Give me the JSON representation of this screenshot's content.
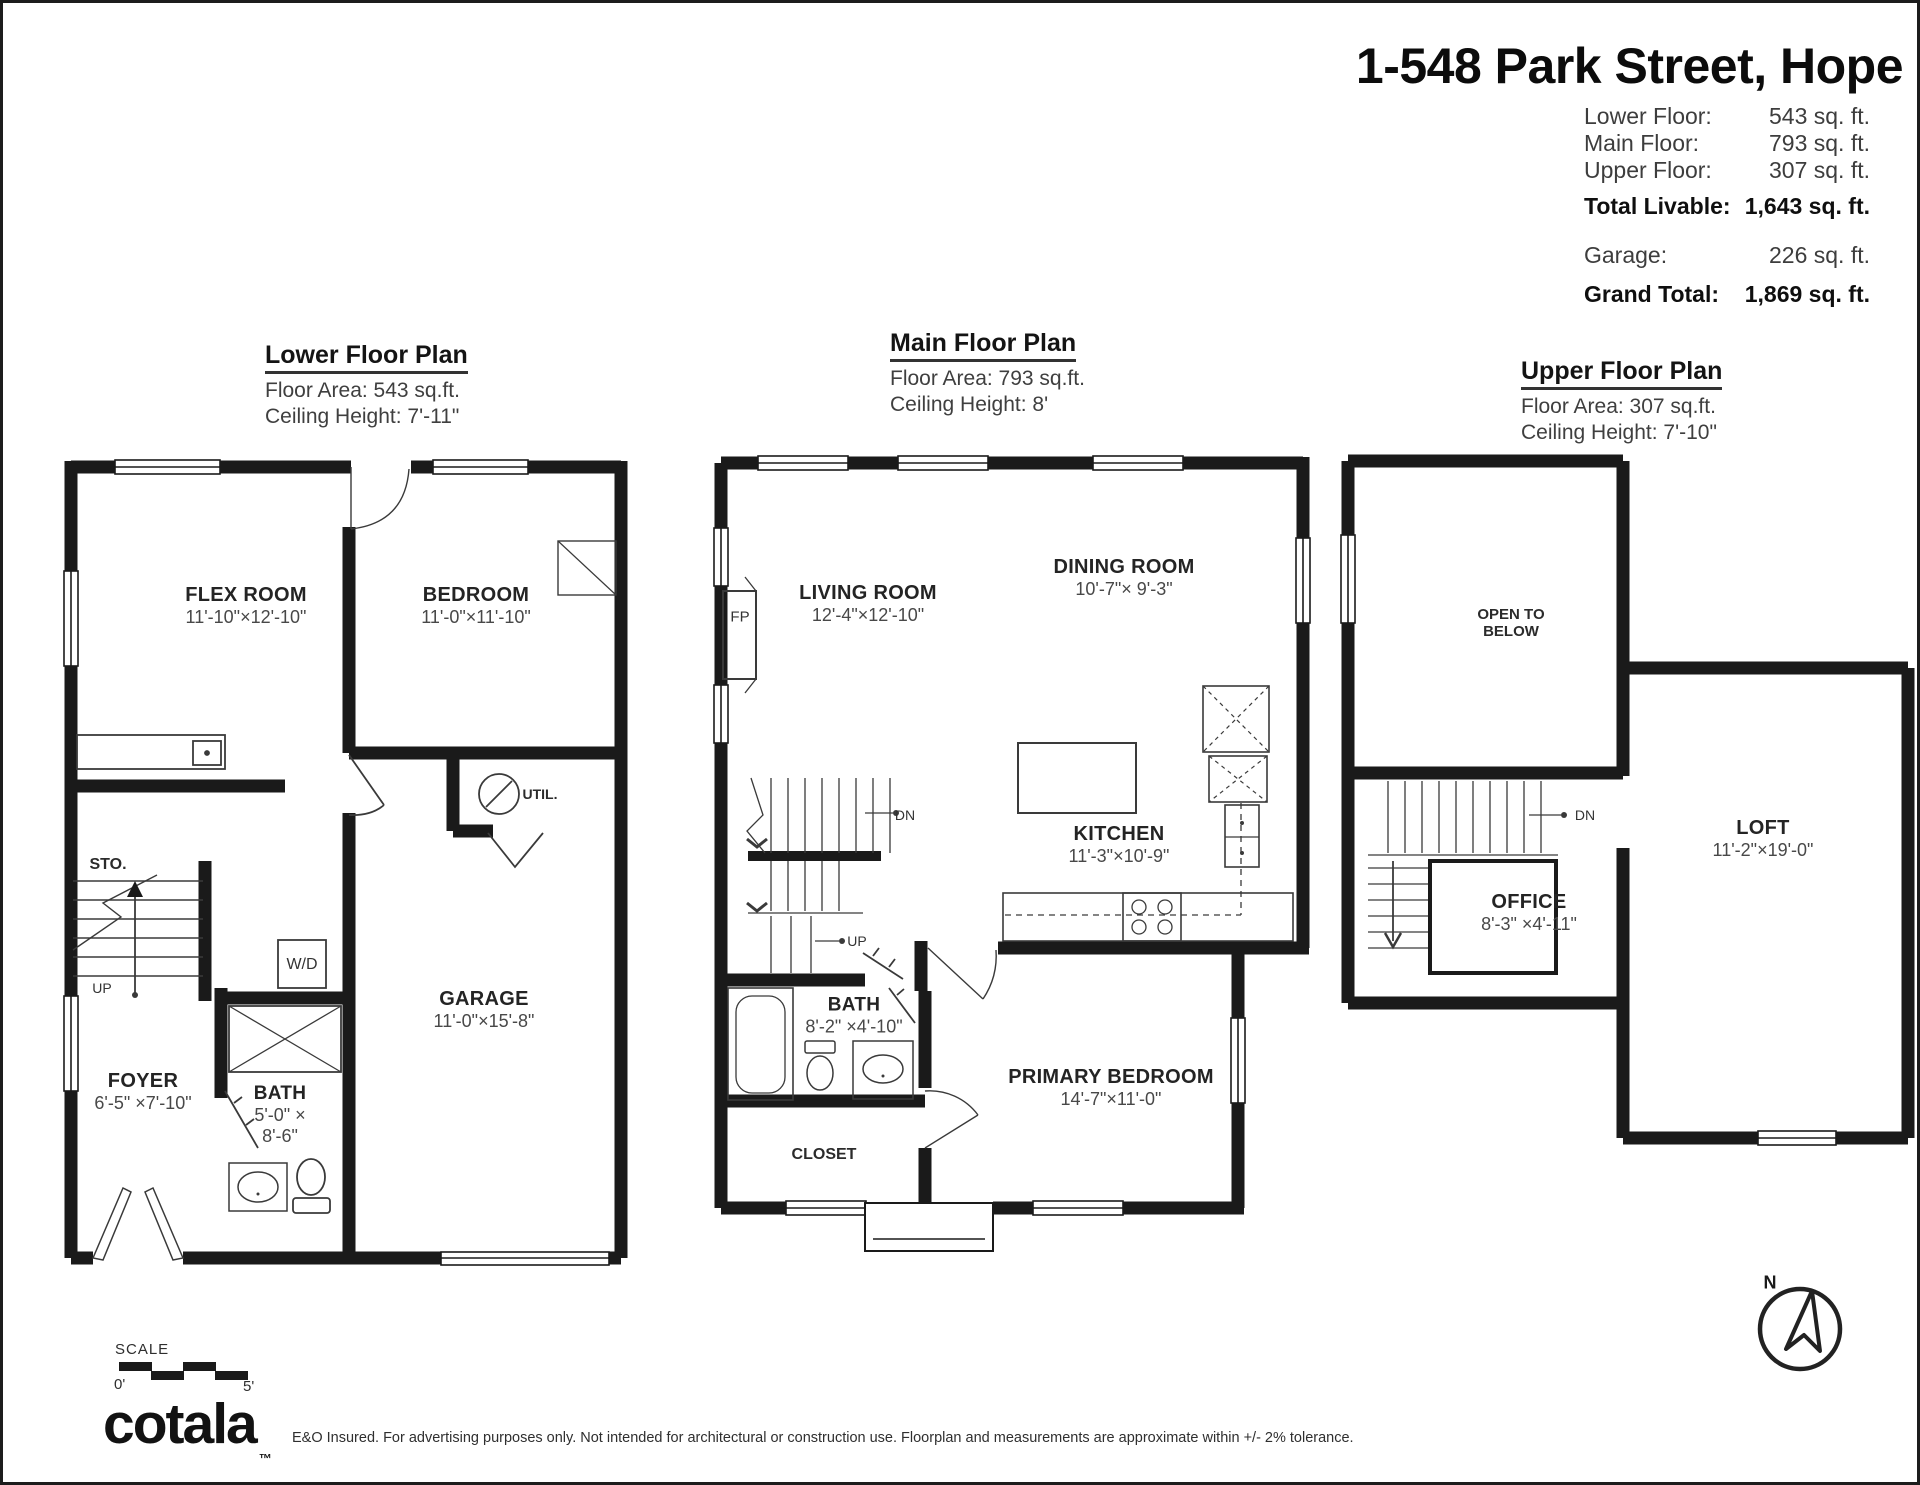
{
  "header": {
    "title": "1-548 Park Street, Hope",
    "stats": [
      {
        "label": "Lower Floor:",
        "value": "543 sq. ft."
      },
      {
        "label": "Main Floor:",
        "value": "793 sq. ft."
      },
      {
        "label": "Upper Floor:",
        "value": "307 sq. ft."
      },
      {
        "label": "Total Livable:",
        "value": "1,643 sq. ft."
      },
      {
        "label": "Garage:",
        "value": "226 sq. ft."
      },
      {
        "label": "Grand Total:",
        "value": "1,869 sq. ft."
      }
    ]
  },
  "plans": {
    "lower": {
      "title": "Lower Floor Plan",
      "floor_area": "Floor Area: 543 sq.ft.",
      "ceiling_height": "Ceiling Height: 7'-11\"",
      "rooms": {
        "flex": {
          "name": "FLEX ROOM",
          "dims": "11'-10\"×12'-10\""
        },
        "bedroom": {
          "name": "BEDROOM",
          "dims": "11'-0\"×11'-10\""
        },
        "garage": {
          "name": "GARAGE",
          "dims": "11'-0\"×15'-8\""
        },
        "bath": {
          "name": "BATH",
          "dims_line1": "5'-0\" ×",
          "dims_line2": "8'-6\""
        },
        "foyer": {
          "name": "FOYER",
          "dims": "6'-5\" ×7'-10\""
        }
      },
      "annotations": {
        "storage": "STO.",
        "up": "UP",
        "washer_dryer": "W/D",
        "utility": "UTIL."
      }
    },
    "main": {
      "title": "Main Floor Plan",
      "floor_area": "Floor Area: 793 sq.ft.",
      "ceiling_height": "Ceiling Height: 8'",
      "rooms": {
        "living": {
          "name": "LIVING ROOM",
          "dims": "12'-4\"×12'-10\""
        },
        "dining": {
          "name": "DINING ROOM",
          "dims": "10'-7\"× 9'-3\""
        },
        "kitchen": {
          "name": "KITCHEN",
          "dims": "11'-3\"×10'-9\""
        },
        "bath": {
          "name": "BATH",
          "dims": "8'-2\" ×4'-10\""
        },
        "primary": {
          "name": "PRIMARY BEDROOM",
          "dims": "14'-7\"×11'-0\""
        },
        "closet": {
          "name": "CLOSET"
        }
      },
      "annotations": {
        "fireplace": "FP",
        "down": "DN",
        "up": "UP"
      }
    },
    "upper": {
      "title": "Upper Floor Plan",
      "floor_area": "Floor Area: 307 sq.ft.",
      "ceiling_height": "Ceiling Height: 7'-10\"",
      "rooms": {
        "open_to_below": {
          "line1": "OPEN TO",
          "line2": "BELOW"
        },
        "loft": {
          "name": "LOFT",
          "dims": "11'-2\"×19'-0\""
        },
        "office": {
          "name": "OFFICE",
          "dims": "8'-3\" ×4'-11\""
        }
      },
      "annotations": {
        "down": "DN"
      }
    }
  },
  "footer": {
    "scale_label": "SCALE",
    "scale_start": "0'",
    "scale_end": "5'",
    "logo_text": "cotala",
    "logo_tm": "™",
    "disclaimer": "E&O Insured. For advertising purposes only. Not intended for architectural or construction use. Floorplan and measurements are approximate within +/- 2% tolerance."
  },
  "compass": {
    "north_label": "N"
  }
}
